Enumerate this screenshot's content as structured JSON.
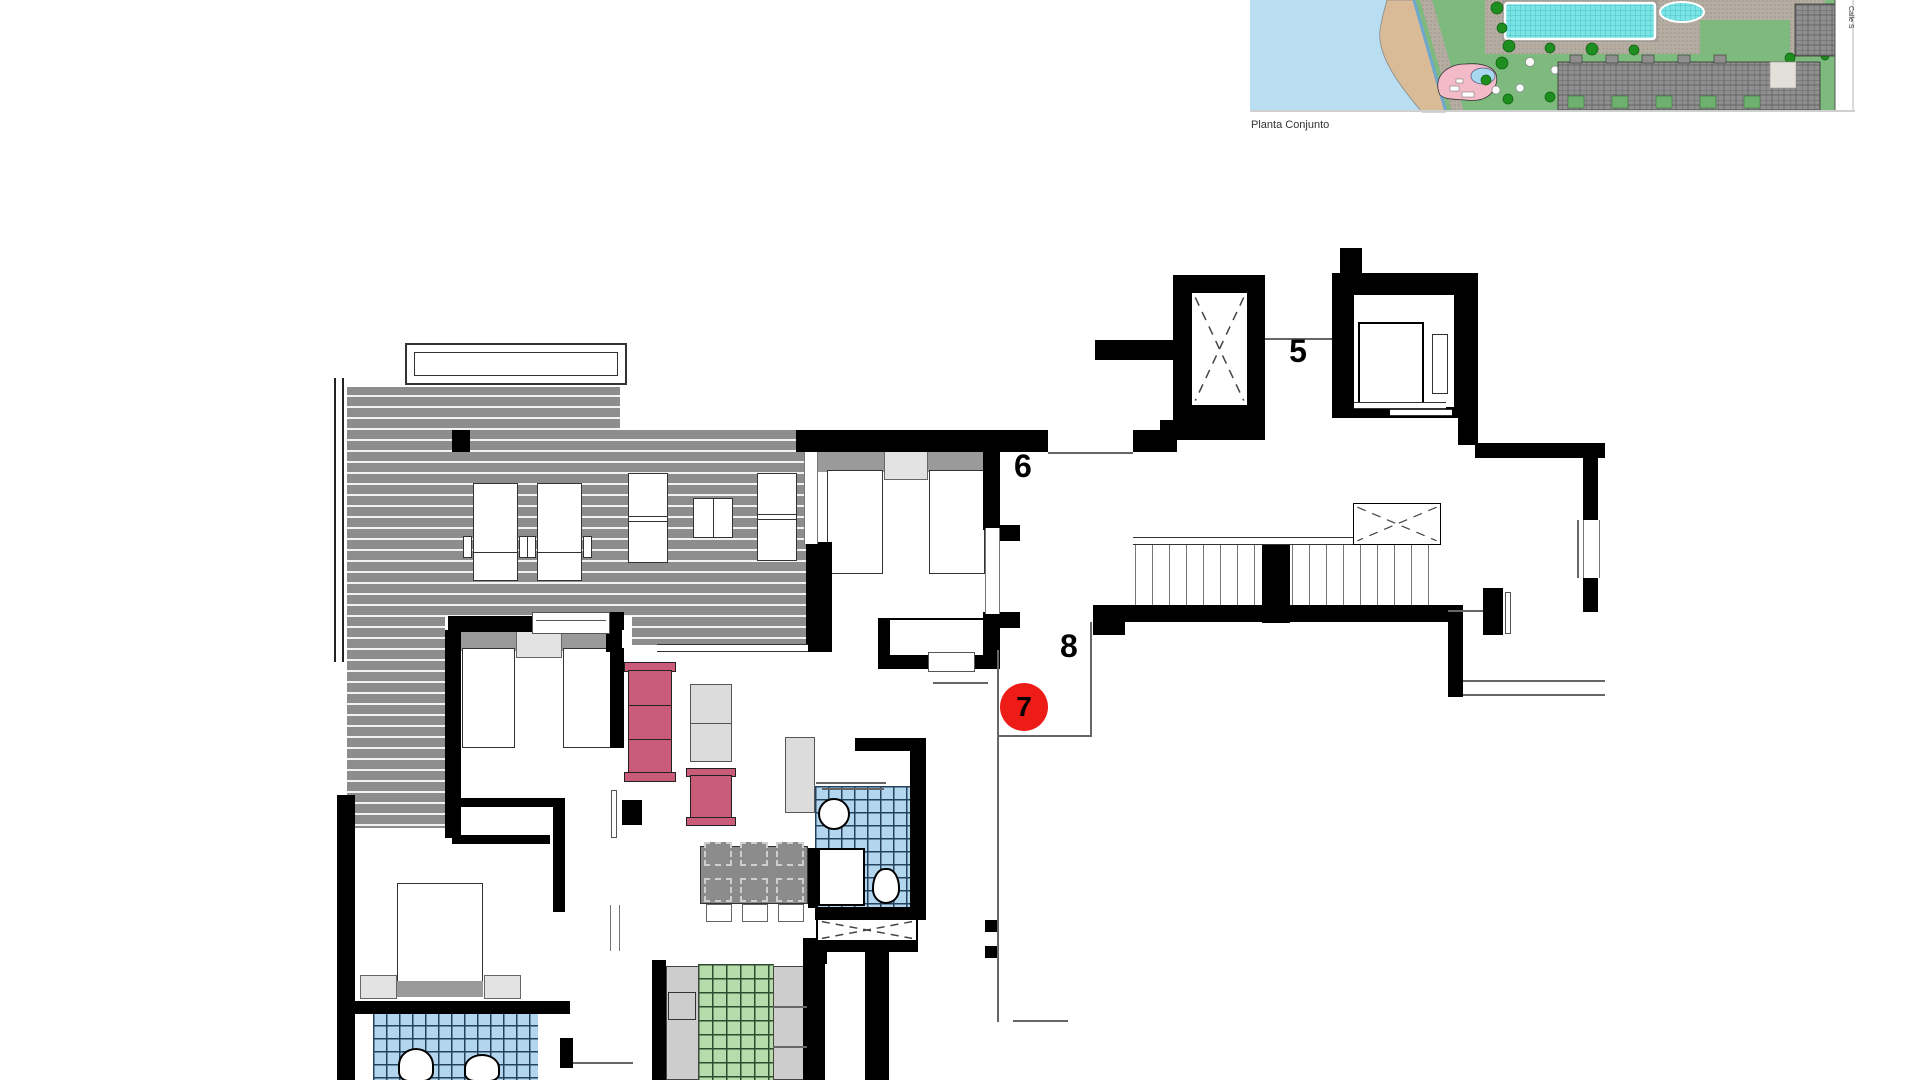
{
  "site_plan": {
    "caption": "Planta Conjunto",
    "street_label": "Calle S",
    "colors": {
      "sea": "#b9ddf1",
      "beach": "#d9bb97",
      "lawn": "#7eb97e",
      "pool": "#7de4e6",
      "kids_pool_area": "#f3bac8",
      "buildings": "#8f8f8f",
      "trees": "#1e8e1e"
    }
  },
  "floor_plan": {
    "unit_labels": [
      {
        "text": "5"
      },
      {
        "text": "6"
      },
      {
        "text": "8"
      }
    ],
    "highlighted_unit": {
      "text": "7",
      "badge_color": "#ed1c16"
    },
    "colors": {
      "walls": "#000000",
      "deck": "#8d8d8d",
      "sofa": "#c95c78",
      "bath_tiles": "#b3d6ef",
      "kitchen_tiles": "#b7dcab",
      "counters": "#cdcdcd"
    }
  }
}
